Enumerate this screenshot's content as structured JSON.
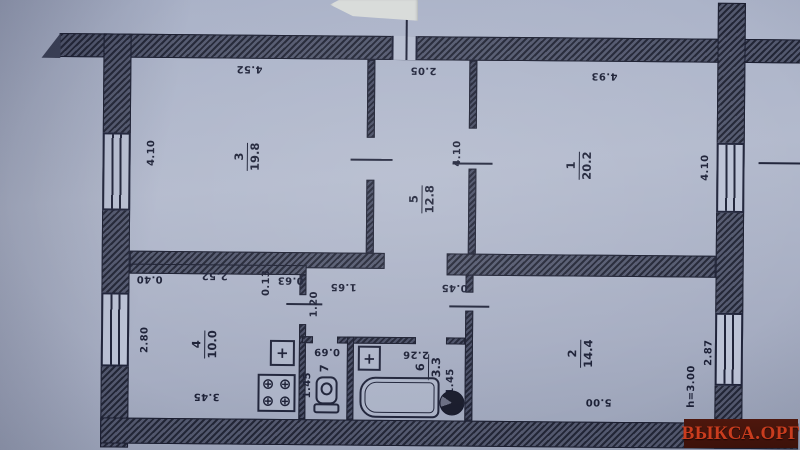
{
  "watermark": {
    "text": "ВЫКСА.ОРГ",
    "bg_color": "#40110a",
    "text_color": "#c93c1e"
  },
  "plan": {
    "rooms": [
      {
        "number": "3",
        "area": "19.8"
      },
      {
        "number": "5",
        "area": "12.8"
      },
      {
        "number": "1",
        "area": "20.2"
      },
      {
        "number": "4",
        "area": "10.0"
      },
      {
        "number": "7",
        "area": ""
      },
      {
        "number": "6",
        "area": "3.3"
      },
      {
        "number": "2",
        "area": "14.4"
      }
    ],
    "dims": {
      "room3_top": "4.52",
      "room3_left": "4.10",
      "hall5_top": "2.05",
      "room1_top": "4.93",
      "room1_right": "4.10",
      "room5_door": "4.10",
      "kitchen_offset": "0.40",
      "kitchen_top": "2.52",
      "wall_step": "0.13",
      "kitchen_door_seg": "0.63",
      "hallway_top": "1.65",
      "kitchen_door": "1.20",
      "room2_door_seg": "0.45",
      "kitchen_left": "2.80",
      "kitchen_bottom": "3.45",
      "wc_top": "0.69",
      "wc_side": "1.45",
      "bath_top": "2.26",
      "bath_side": "1.45",
      "room2_bottom": "5.00",
      "room2_right": "2.87",
      "ceiling_height": "h=3.00"
    },
    "icons": {
      "sink_cross": "+",
      "burner": "⊕"
    }
  }
}
